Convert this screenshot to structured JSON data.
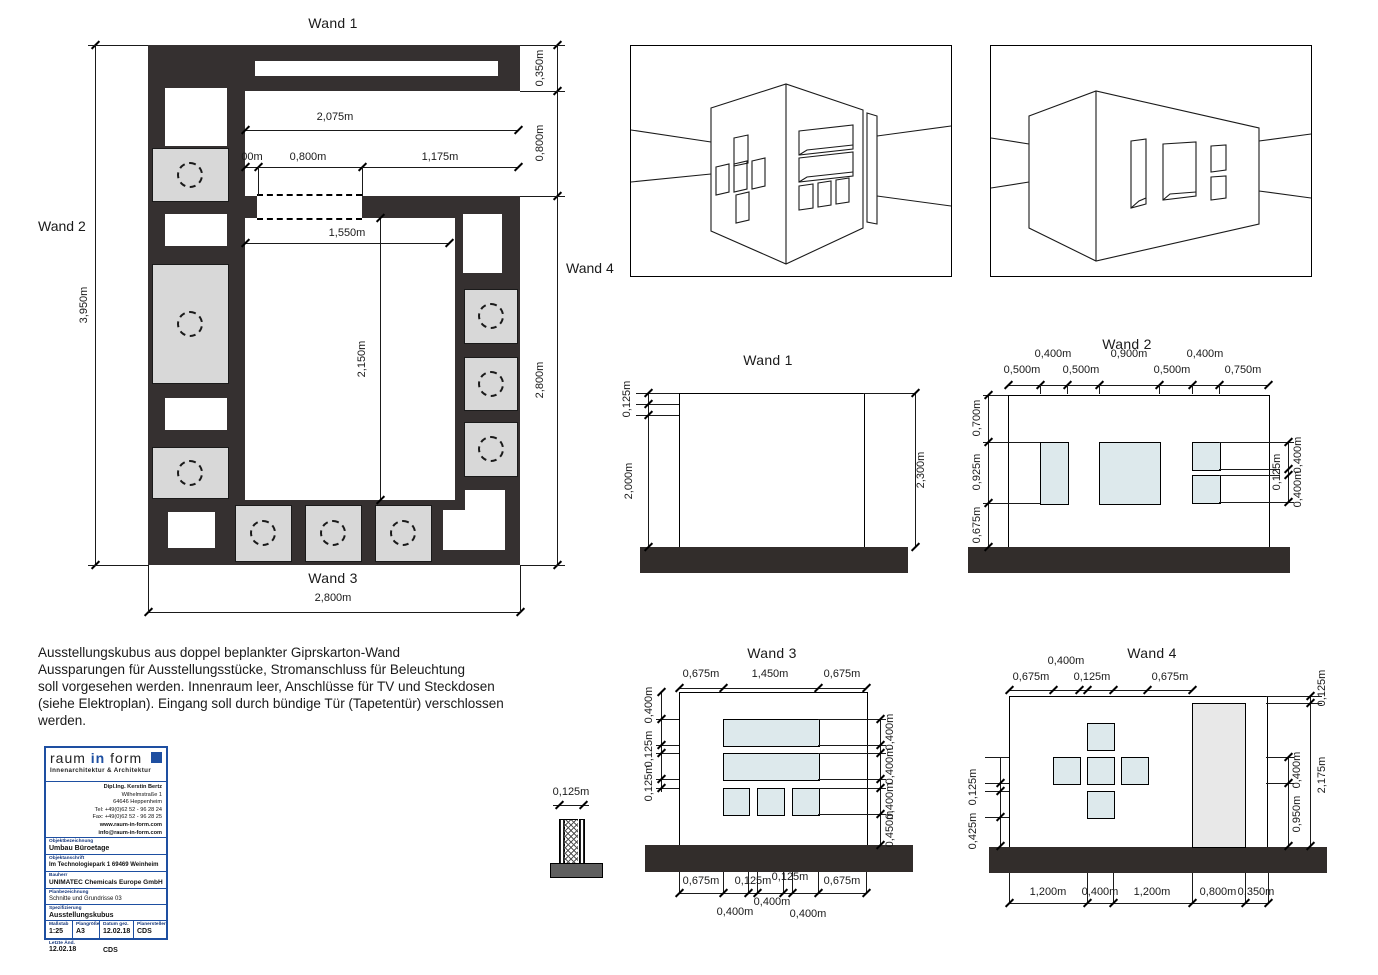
{
  "plan": {
    "wand1_label": "Wand 1",
    "wand2_label": "Wand 2",
    "wand3_label": "Wand 3",
    "wand4_label": "Wand 4",
    "dim_total_height": "3,950m",
    "dim_top_width": "2,075m",
    "dim_top_seg1": "00m",
    "dim_top_seg2": "0,800m",
    "dim_top_seg3": "1,175m",
    "dim_right_seg1": "0,350m",
    "dim_right_seg2": "0,800m",
    "dim_right_seg3": "2,800m",
    "dim_inner_width": "1,550m",
    "dim_inner_height": "2,150m",
    "dim_bottom_width": "2,800m"
  },
  "wand1": {
    "title": "Wand 1",
    "dim_left_top": "0,125m",
    "dim_left": "2,000m",
    "dim_right": "2,300m"
  },
  "wand2": {
    "title": "Wand 2",
    "top_row1": [
      "0,400m",
      "0,900m",
      "0,400m"
    ],
    "top_row2": [
      "0,500m",
      "0,500m",
      "0,500m",
      "0,750m"
    ],
    "left": [
      "0,700m",
      "0,925m",
      "0,675m"
    ],
    "right": [
      "0,400m",
      "0,125m",
      "0,400m"
    ]
  },
  "wand3": {
    "title": "Wand 3",
    "top": [
      "0,675m",
      "1,450m",
      "0,675m"
    ],
    "left": [
      "0,400m",
      "0,125m",
      "0,125m"
    ],
    "right": [
      "0,400m",
      "0,400m",
      "0,400m",
      "0,450m"
    ],
    "bottom_row1": [
      "0,675m",
      "0,125m",
      "0,125m",
      "0,675m"
    ],
    "bottom_row2": [
      "0,400m",
      "0,400m",
      "0,400m"
    ]
  },
  "wand4": {
    "title": "Wand 4",
    "top_row1": "0,400m",
    "top_row2": [
      "0,675m",
      "0,125m",
      "0,675m"
    ],
    "left": [
      "0,125m",
      "0,425m"
    ],
    "right_inner": [
      "0,400m",
      "0,950m"
    ],
    "right_outer": [
      "0,125m",
      "2,175m"
    ],
    "bottom": [
      "1,200m",
      "0,400m",
      "1,200m",
      "0,800m",
      "0,350m"
    ]
  },
  "detail": {
    "dim": "0,125m"
  },
  "notes": {
    "line1": "Ausstellungskubus aus doppel beplankter Giprskarton-Wand",
    "line2": "Aussparungen für Ausstellungsstücke, Stromanschluss für Beleuchtung",
    "line3": "soll vorgesehen werden. Innenraum leer, Anschlüsse für TV und Steckdosen",
    "line4": "(siehe Elektroplan). Eingang soll durch bündige Tür (Tapetentür) verschlossen",
    "line5": "werden."
  },
  "titleblock": {
    "logo_raum": "raum ",
    "logo_in": "in",
    "logo_form": " form",
    "subtitle": "Innenarchitektur & Architektur",
    "contact_line1": "Dipl.Ing. Kerstin Bertz",
    "contact_line2": "Wilhelmstraße 1",
    "contact_line3": "64646 Heppenheim",
    "tel_line": "Tel:   +49(0)62 52 - 96 28 24",
    "fax_line": "Fax:   +49(0)62 52 - 96 28 25",
    "web": "www.raum-in-form.com",
    "email": "info@raum-in-form.com",
    "field1_label": "Objektbezeichnung",
    "field1_value": "Umbau Büroetage",
    "field2_label": "Objektanschrift",
    "field2_value": "Im Technologiepark 1  69469 Weinheim",
    "field3_label": "Bauherr",
    "field3_value": "UNIMATEC Chemicals Europe GmbH",
    "field4_label": "Planbezeichnung",
    "field4_value": "Schnitte und Grundrisse 03",
    "field5_label": "Spezifizierung",
    "field5_value": "Ausstellungskubus",
    "scale_label": "Maßstab",
    "scale_value": "1:25",
    "size_label": "Plangröße",
    "size_value": "A3",
    "date_label": "Datum gez.",
    "date_value": "12.02.18",
    "author_label": "Planersteller",
    "author_value": "CDS",
    "change_label": "Letzte Änd.",
    "change_date": "12.02.18",
    "change_author": "CDS"
  },
  "colors": {
    "wall_dark": "#353030",
    "niche_blue": "#dde9ec",
    "lamp_gray": "#d8d8d8",
    "door_gray": "#e8e8e8",
    "accent_blue": "#1e4fa1"
  }
}
